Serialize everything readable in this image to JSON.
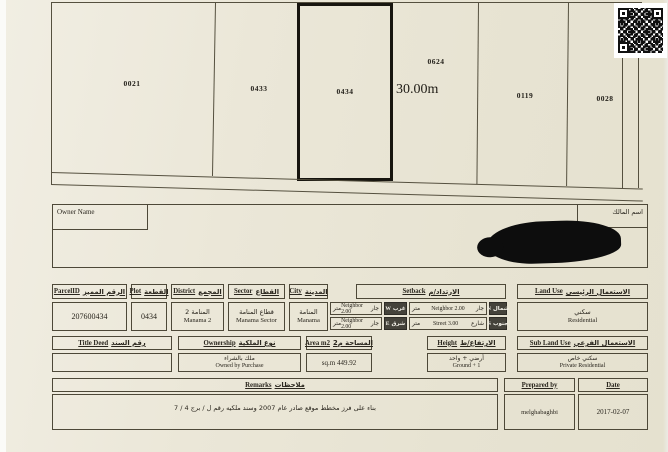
{
  "document_type": "land-plot-certificate-scan",
  "colors": {
    "paper": "#eae6d7",
    "ink": "#2a261e",
    "line": "#55503f",
    "badge_bg": "#45433b",
    "redaction": "#0d0d0d"
  },
  "map": {
    "parcels": [
      {
        "id": "0021"
      },
      {
        "id": "0433"
      },
      {
        "id": "0434",
        "highlighted": true
      },
      {
        "id": "0624"
      },
      {
        "id": "0119"
      },
      {
        "id": "0028"
      }
    ],
    "dimension_label": "30.00m",
    "qr": "qr-code"
  },
  "owner": {
    "label_en": "Owner Name",
    "label_ar": "اسم المالك"
  },
  "fields": {
    "parcel_id": {
      "en": "ParcelID",
      "ar": "الرقم المميز",
      "value": "207600434"
    },
    "plot": {
      "en": "Plot",
      "ar": "القطعة",
      "value": "0434"
    },
    "district": {
      "en": "District",
      "ar": "المجمع",
      "value_ar": "المنامة 2",
      "value_en": "Manama 2"
    },
    "sector": {
      "en": "Sector",
      "ar": "القطاع",
      "value_ar": "قطاع المنامة",
      "value_en": "Manama Sector"
    },
    "city": {
      "en": "City",
      "ar": "المدينة",
      "value_ar": "المنامة",
      "value_en": "Manama"
    },
    "setback": {
      "en": "Setback",
      "ar": "الارتداد/م",
      "unit_ar": "متر",
      "cells": [
        {
          "dir_en": "W",
          "dir_ar": "غرب",
          "value_en": "Neighbor 2.00",
          "value_ar": "جار"
        },
        {
          "dir_en": "N",
          "dir_ar": "شمال",
          "value_en": "Neighbor 2.00",
          "value_ar": "جار"
        },
        {
          "dir_en": "E",
          "dir_ar": "شرق",
          "value_en": "Neighbor 2.00",
          "value_ar": "جار"
        },
        {
          "dir_en": "S",
          "dir_ar": "جنوب",
          "value_en": "Street 3.00",
          "value_ar": "شارع"
        }
      ]
    },
    "land_use": {
      "en": "Land Use",
      "ar": "الاستعمال الرئيسي",
      "value_ar": "سكني",
      "value_en": "Residential"
    },
    "title_deed": {
      "en": "Title Deed",
      "ar": "رقم السند",
      "value": ""
    },
    "ownership": {
      "en": "Ownership",
      "ar": "نوع الملكية",
      "value_ar": "ملك بالشراء",
      "value_en": "Owned by Purchase"
    },
    "area": {
      "en": "Area m2",
      "ar": "المساحة م2",
      "value": "sq.m 449.92"
    },
    "height": {
      "en": "Height",
      "ar": "الارتفاع/ط",
      "value_ar": "أرضي + واحد",
      "value_en": "Ground + 1"
    },
    "sub_land_use": {
      "en": "Sub Land Use",
      "ar": "الاستعمال الفرعي",
      "value_ar": "سكني خاص",
      "value_en": "Private Residential"
    },
    "remarks": {
      "en": "Remarks",
      "ar": "ملاحظات",
      "value": "بناء على فرز مخطط موقع صادر عام 2007 وسند ملكيه رقم ل / برج 4 / 7"
    },
    "prepared_by": {
      "en": "Prepared by",
      "value": "melghabaghbi"
    },
    "date": {
      "en": "Date",
      "value": "2017-02-07"
    }
  }
}
